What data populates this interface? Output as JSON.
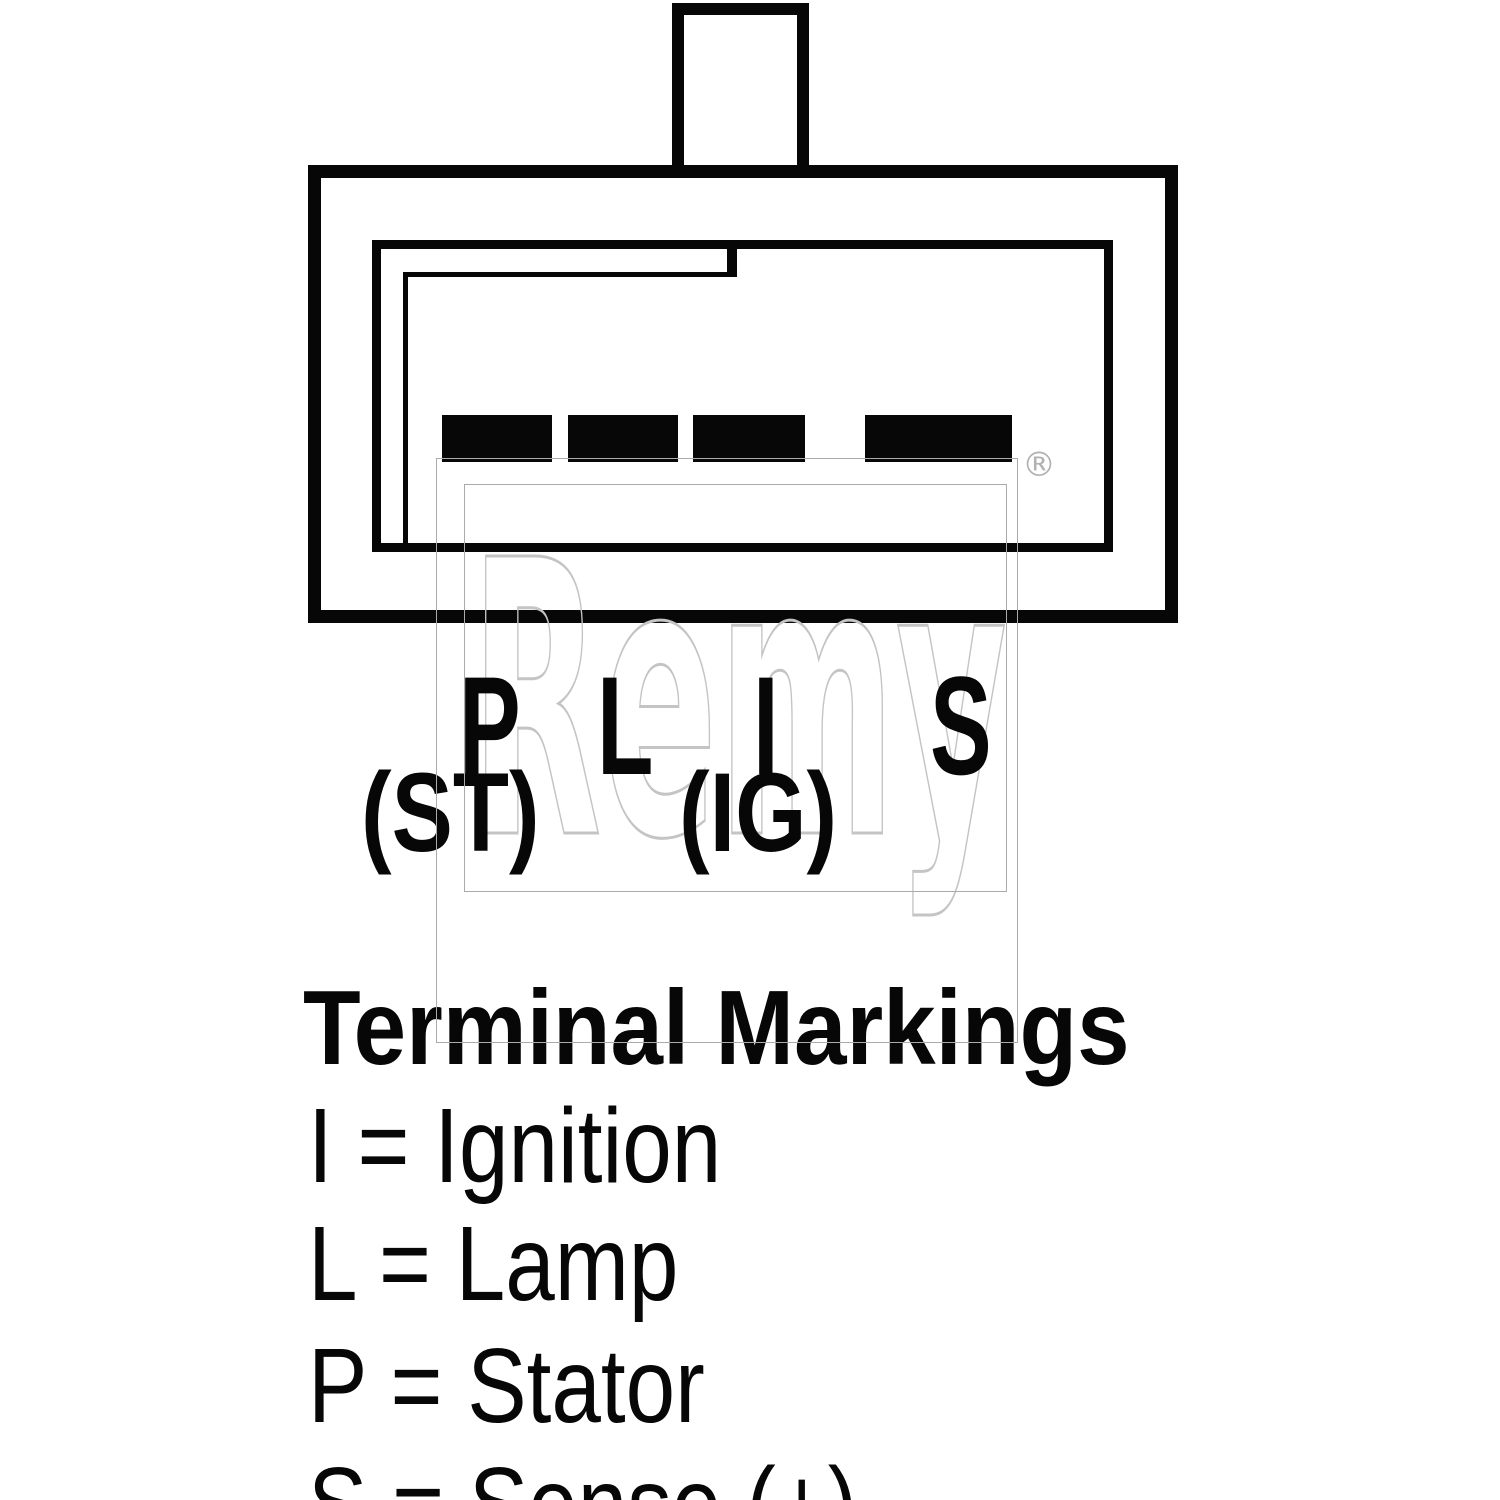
{
  "connector_diagram": {
    "description": "4-pin alternator plug connector outline",
    "pin_count": 4,
    "terminals": [
      {
        "mark": "P",
        "alt": "(ST)"
      },
      {
        "mark": "L",
        "alt": ""
      },
      {
        "mark": "I",
        "alt": "(IG)"
      },
      {
        "mark": "S",
        "alt": ""
      }
    ],
    "registered_symbol": "®"
  },
  "watermark": {
    "text": "Remy"
  },
  "legend": {
    "heading": "Terminal Markings",
    "entries": [
      {
        "key": "I",
        "meaning": "Ignition",
        "text": "I = Ignition"
      },
      {
        "key": "L",
        "meaning": "Lamp",
        "text": "L = Lamp"
      },
      {
        "key": "P",
        "meaning": "Stator",
        "text": "P = Stator"
      },
      {
        "key": "S",
        "meaning": "Sense (+)",
        "text": "S = Sense (+)"
      }
    ]
  },
  "colors": {
    "line": "#070707",
    "watermark_gray": "#b2b2b2",
    "background": "#ffffff"
  }
}
